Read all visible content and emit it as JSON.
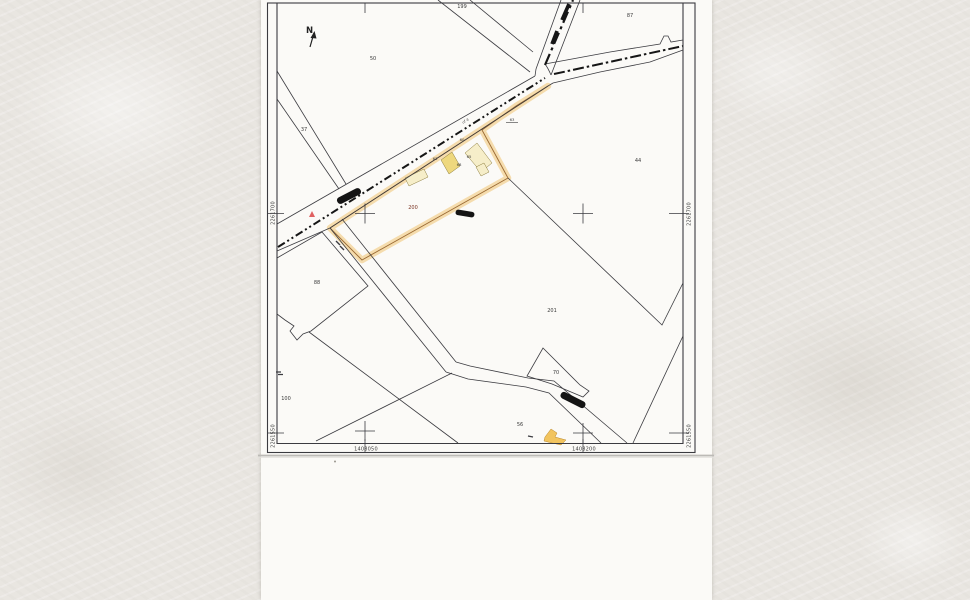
{
  "map": {
    "north": "N",
    "road_label": "uf 4",
    "parcel_labels": {
      "p199": "199",
      "p87": "87",
      "p50": "50",
      "p37": "37",
      "p44": "44",
      "p201": "201",
      "p88": "88",
      "p100": "100",
      "p70": "70",
      "p56": "56",
      "p200": "200"
    },
    "building_labels": {
      "road63": "63",
      "b60": "60",
      "b63": "63",
      "b65": "65",
      "b68": "68"
    },
    "grid": {
      "left_top": "2261700",
      "left_bottom": "2261550",
      "right_top": "2261700",
      "right_bottom": "2261550",
      "bottom_left": "1408050",
      "bottom_right": "1408200"
    },
    "colors": {
      "line": "#3b3b40",
      "highlight_fill": "#f5dcad",
      "highlight_edge": "#9a6a33",
      "building_yellow": "#eed87e",
      "building_pale": "#f6eec9",
      "building_gold": "#f2c45e",
      "subject_label": "#7a3322",
      "mark_red": "#e06060",
      "vehicle_black": "#141414"
    }
  }
}
